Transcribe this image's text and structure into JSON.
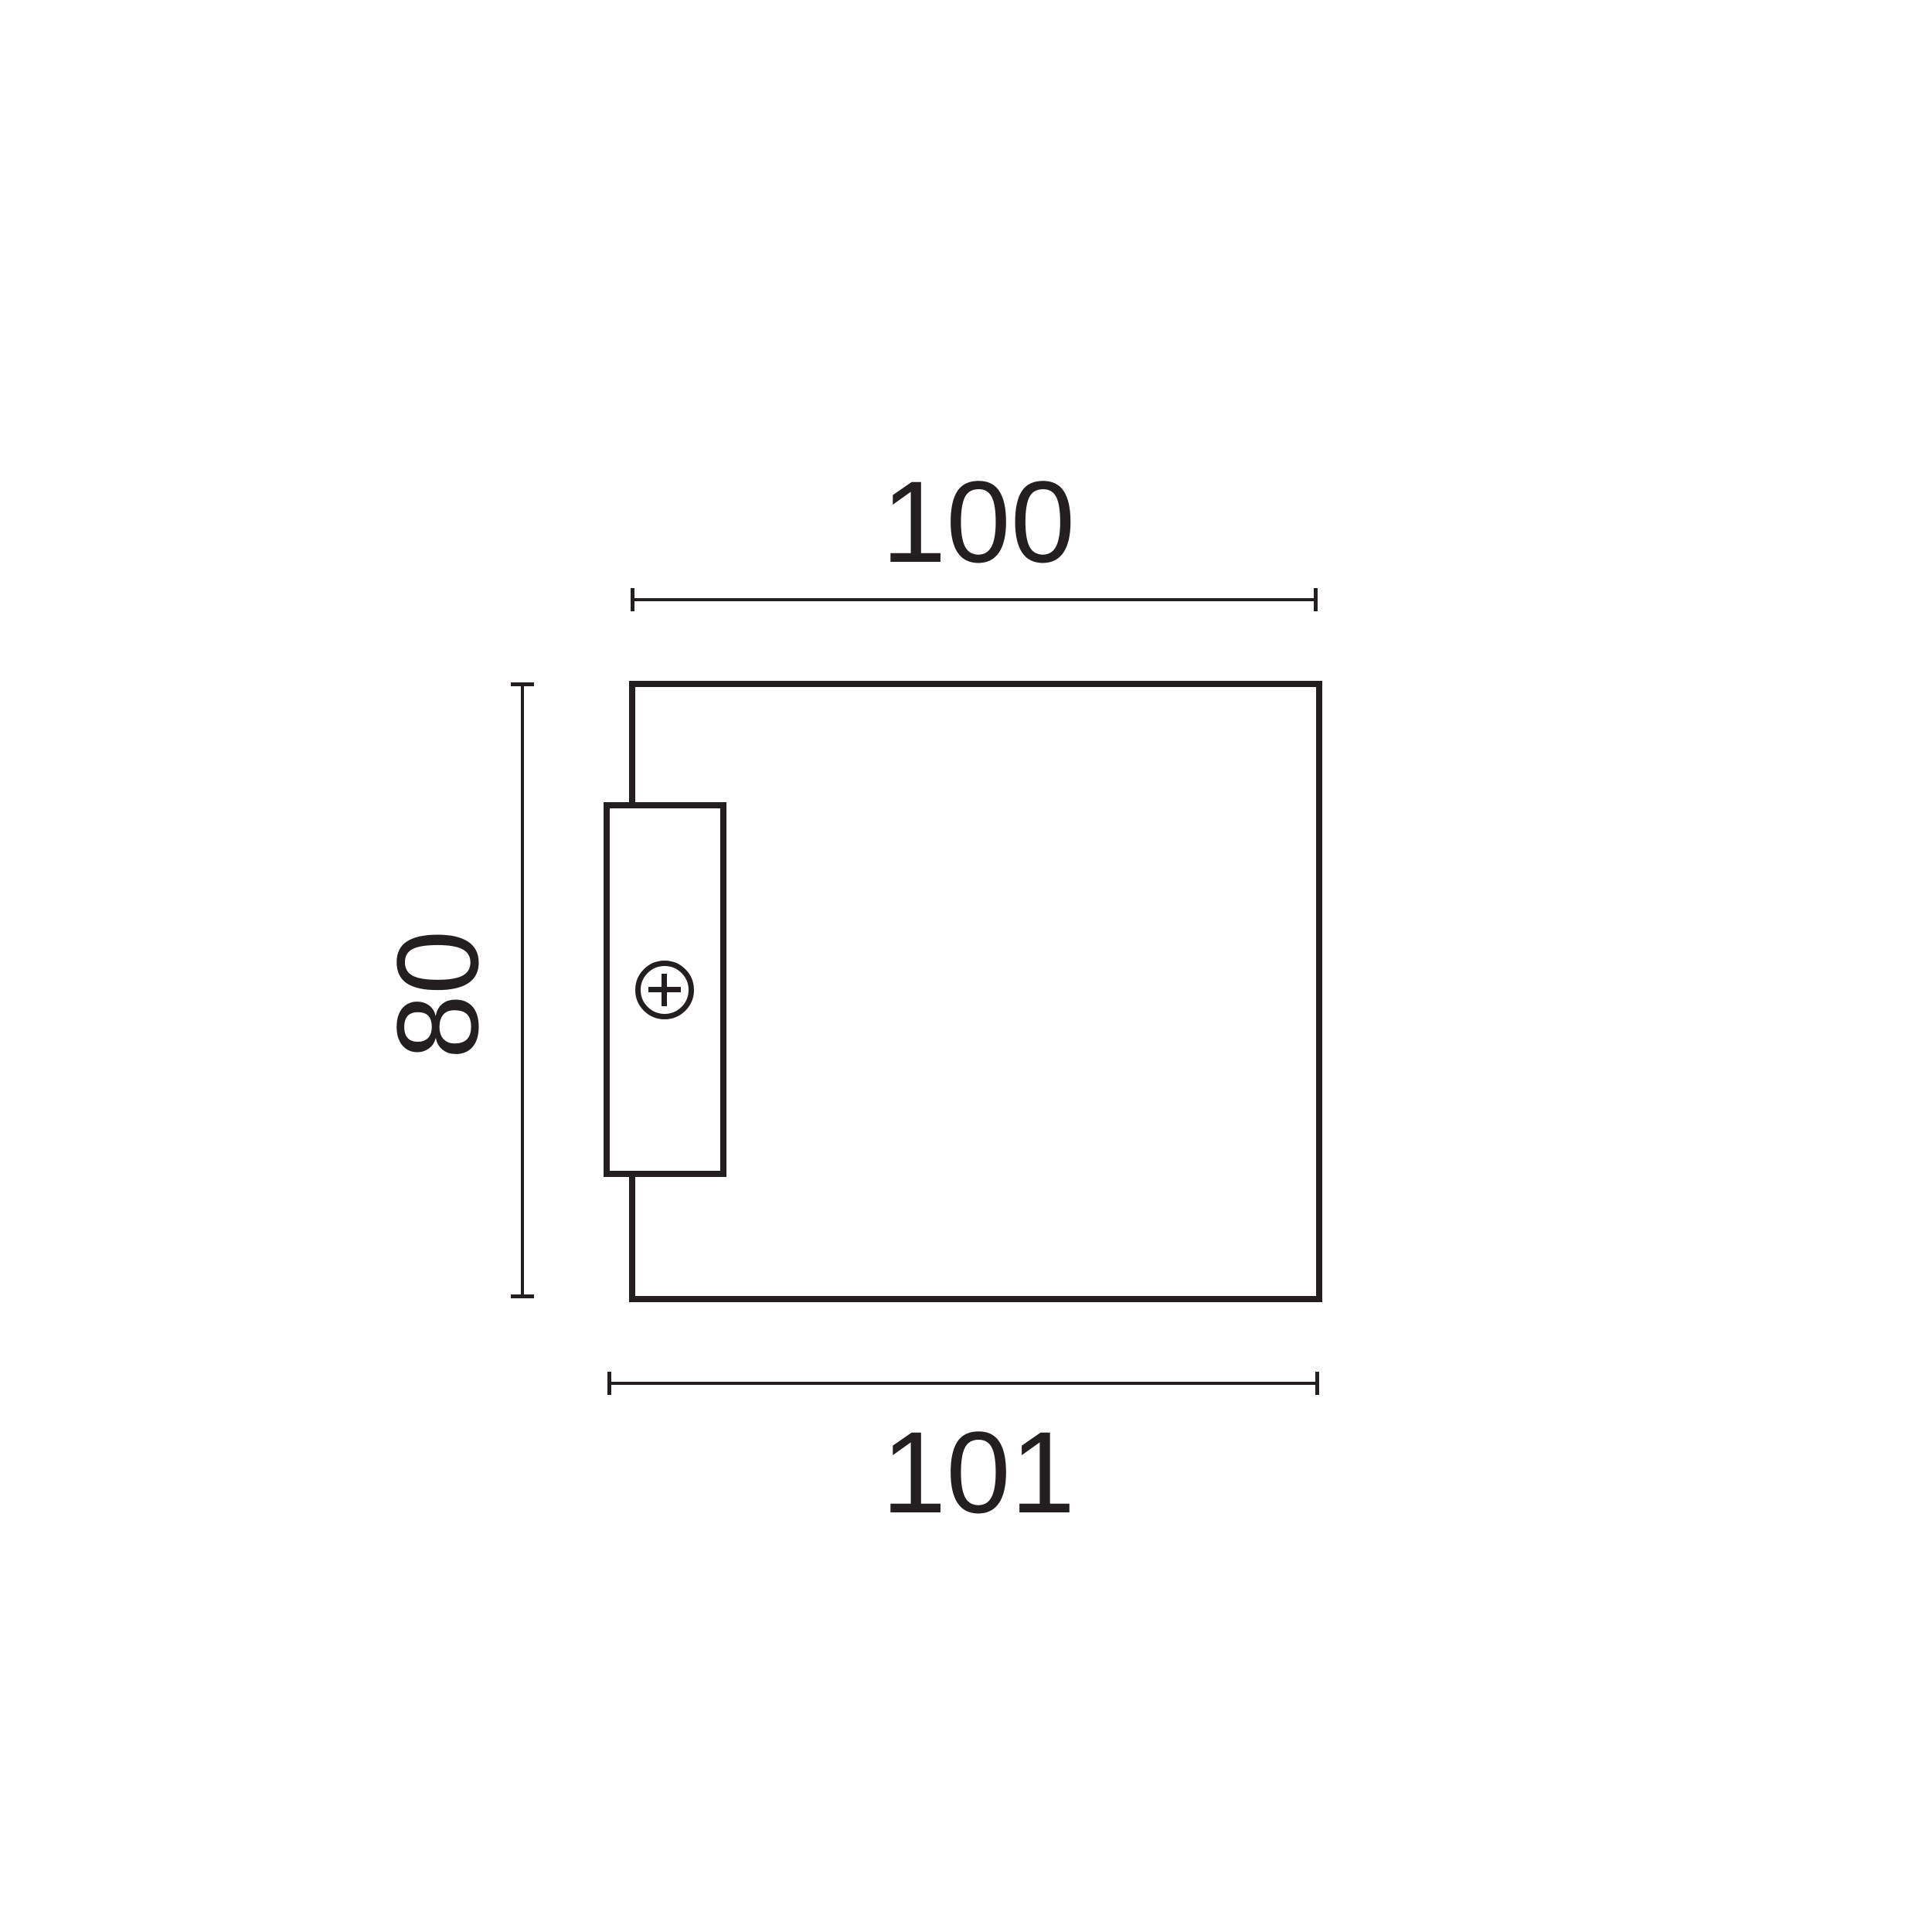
{
  "drawing": {
    "background": "#ffffff",
    "line_color": "#231f20",
    "dimensions": {
      "top": {
        "value": "100"
      },
      "left": {
        "value": "80"
      },
      "bottom": {
        "value": "101"
      }
    },
    "icons": {
      "screw_head_icon": "circle-with-cross"
    }
  }
}
